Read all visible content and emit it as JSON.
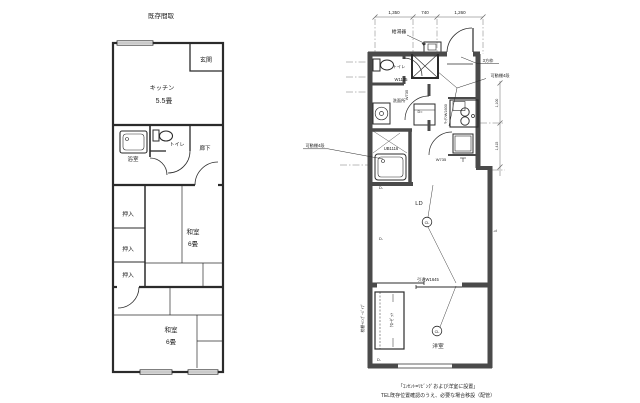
{
  "page": {
    "bg": "#ffffff",
    "line_color": "#2b2b2b",
    "wall_color": "#4a4a4a"
  },
  "left_plan": {
    "title": "既存間取",
    "labels": {
      "genkan": "玄関",
      "kitchen_name": "キッチン",
      "kitchen_size": "5.5畳",
      "bath": "浴室",
      "toilet": "トイレ",
      "hall": "廊下",
      "closet1": "押入",
      "closet2": "押入",
      "closet3": "押入",
      "washitsu1_name": "和室",
      "washitsu1_size": "6畳",
      "washitsu2_name": "和室",
      "washitsu2_size": "6畳"
    }
  },
  "right_plan": {
    "dims_top": [
      "1,350",
      "740",
      "1,260"
    ],
    "dims_right": [
      "1,100",
      "1,415"
    ],
    "labels": {
      "water_heater": "給湯器",
      "three_way_frame": "3方枠",
      "movable_shelf_right": "可動棚4段",
      "movable_shelf_left": "可動棚4段",
      "toilet": "トイレ",
      "toilet_width": "W1135",
      "door_w735_vertical": "W735",
      "washroom": "洗面所",
      "vanity_mark": "D=",
      "unit_bath": "UB1116",
      "kitchen_vertical": "ｷｯﾁﾝW1600",
      "fridge_door_width": "W735",
      "living": "LD",
      "cl_living": "CL",
      "cl_bedroom": "CL",
      "sliding_door": "引違W1645",
      "closet_vertical": "ｸﾛｰｾﾞｯﾄ",
      "shelf_pipe_vertical": "枕棚+ﾊﾝｶﾞｰﾊﾟｲﾌﾟ",
      "bedroom": "洋室",
      "d2": "D-",
      "d3": "D-",
      "d4": "D-",
      "d5": "-d"
    },
    "notes": [
      "「ｺﾝｾﾝﾄ=ﾘﾋﾞﾝｸﾞおよび洋室に設置」",
      "TEL既存位置確認のうえ、必要な場合移設（配管）"
    ]
  }
}
